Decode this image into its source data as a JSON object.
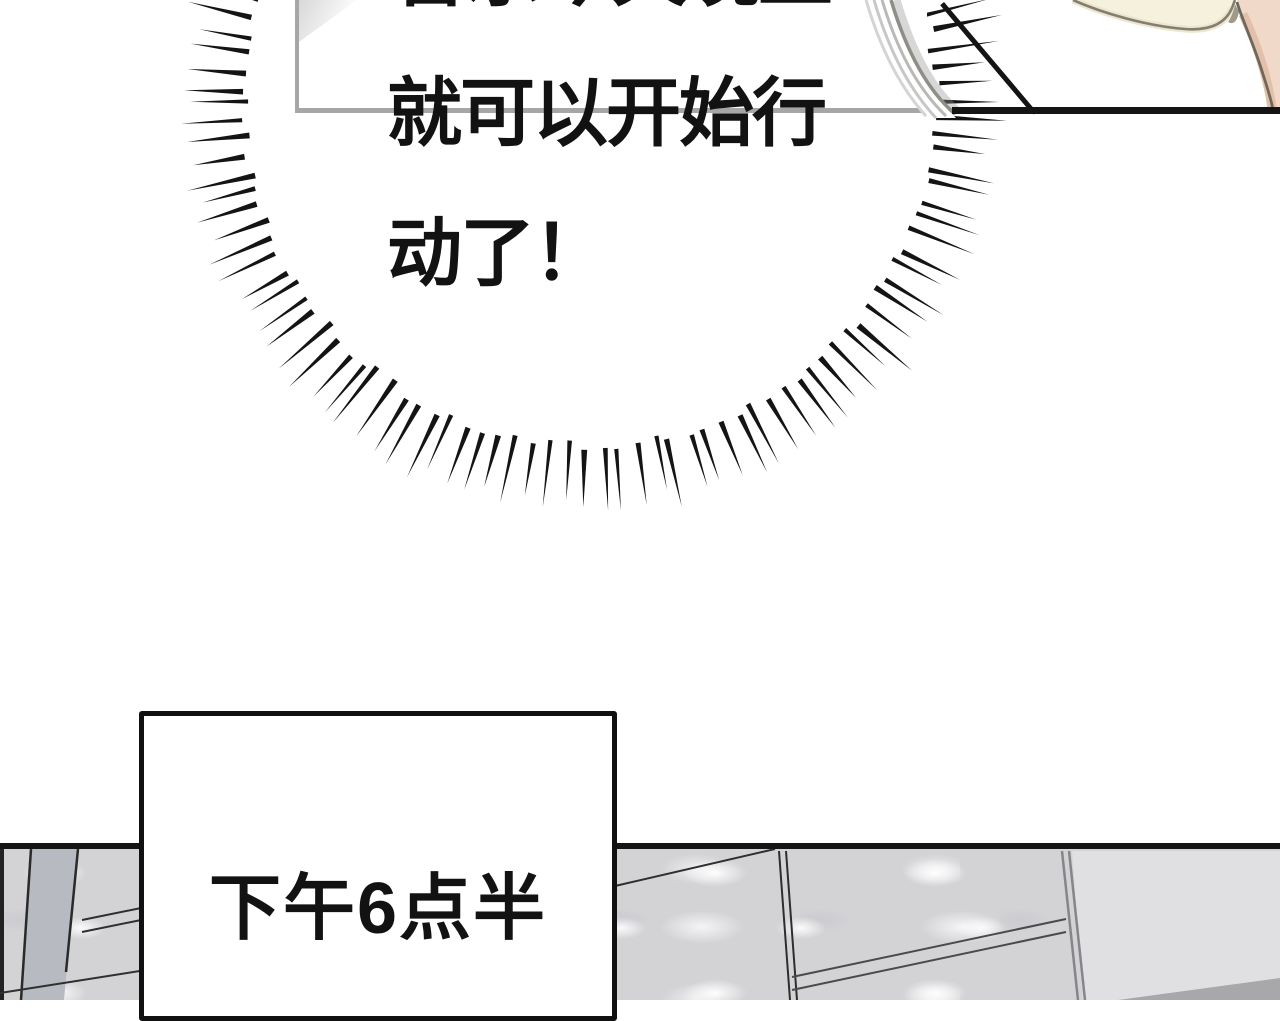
{
  "speech_bubble": {
    "line_partial": "音乐今天晚上",
    "line2": "就可以开始行",
    "line3": "动了！"
  },
  "caption_box": {
    "text": "下午6点半"
  },
  "colors": {
    "bubble_border": "#a6a6a6",
    "panel_divider": "#141414",
    "burst_lines": "#141414",
    "caption_border": "#111111",
    "shoulder_cream": "#f6f1dd",
    "shoulder_peach": "#f0d9c8",
    "outline_brown": "#6e675a",
    "wall_gray": "#d3d3d6",
    "wall_dark_strip": "#b7bbc1",
    "wall_flat_panel": "#e0e0e3",
    "wall_dark_corner": "#a8a8aa"
  }
}
